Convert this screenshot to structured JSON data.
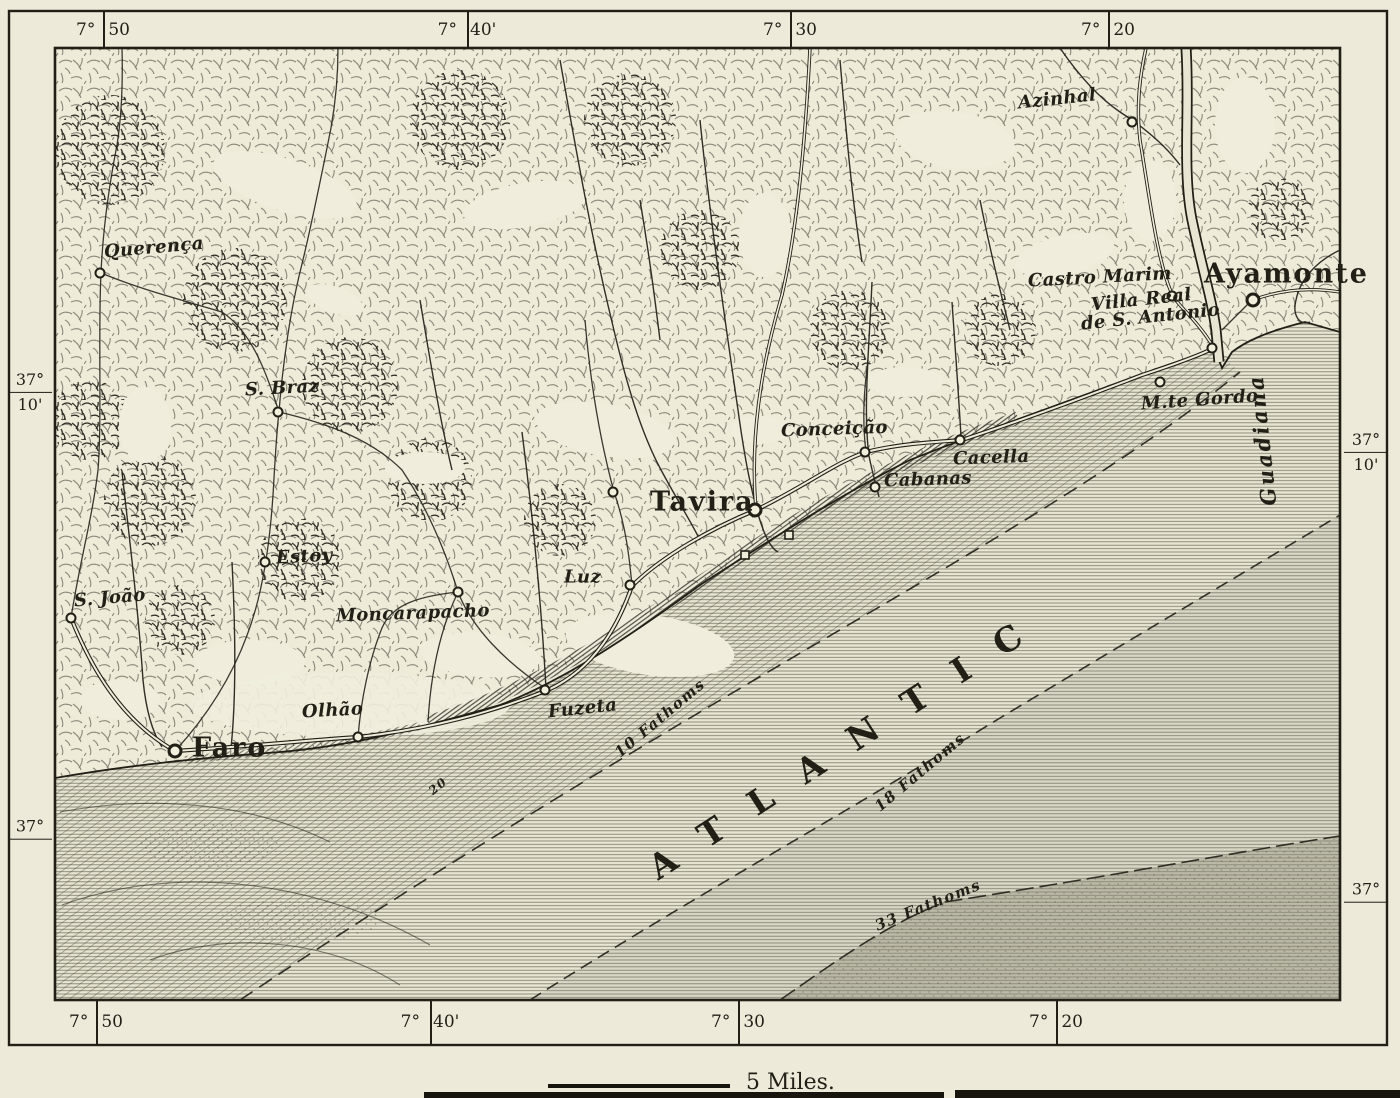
{
  "map": {
    "colors": {
      "paper": "#edead9",
      "ink": "#211f16",
      "sea": "#e8e5d2",
      "sea_deep": "#8b8a7a"
    },
    "scale": {
      "label": "5 Miles."
    },
    "graticule": {
      "top": [
        {
          "deg": "7°",
          "min": "50",
          "x": 103
        },
        {
          "deg": "7°",
          "min": "40'",
          "x": 467
        },
        {
          "deg": "7°",
          "min": "30",
          "x": 790
        },
        {
          "deg": "7°",
          "min": "20",
          "x": 1108
        }
      ],
      "bottom": [
        {
          "deg": "7°",
          "min": "50",
          "x": 96
        },
        {
          "deg": "7°",
          "min": "40'",
          "x": 430
        },
        {
          "deg": "7°",
          "min": "30",
          "x": 738
        },
        {
          "deg": "7°",
          "min": "20",
          "x": 1056
        }
      ],
      "left": [
        {
          "deg": "37°",
          "min": "10'",
          "y": 392
        },
        {
          "deg": "37°",
          "min": "",
          "y": 830
        }
      ],
      "right": [
        {
          "deg": "37°",
          "min": "10'",
          "y": 452
        },
        {
          "deg": "37°",
          "min": "",
          "y": 893
        }
      ]
    },
    "places": [
      {
        "id": "querenca",
        "label": "Querença",
        "x": 104,
        "y": 252,
        "rot": -5,
        "cx": 100,
        "cy": 273,
        "class": "village"
      },
      {
        "id": "azinhal",
        "label": "Azinhal",
        "x": 1018,
        "y": 103,
        "rot": -6,
        "cx": 1132,
        "cy": 122,
        "class": "village"
      },
      {
        "id": "castro-marim",
        "label": "Castro Marim",
        "x": 1028,
        "y": 281,
        "rot": -3,
        "cx": 1172,
        "cy": 296,
        "class": "village"
      },
      {
        "id": "ayamonte",
        "label": "Ayamonte",
        "x": 1204,
        "y": 274,
        "cx": 1253,
        "cy": 300,
        "class": "city"
      },
      {
        "id": "villa-real",
        "label": "Villa Real",
        "label2": "de S. Antonio",
        "x": 1092,
        "y": 314,
        "rot": -6,
        "cx": 1212,
        "cy": 348,
        "class": "village"
      },
      {
        "id": "monte-gordo",
        "label": "M.te Gordo",
        "x": 1141,
        "y": 404,
        "rot": -4,
        "cx": 1160,
        "cy": 382,
        "class": "village"
      },
      {
        "id": "conceicao",
        "label": "Conceição",
        "x": 781,
        "y": 431,
        "rot": -2,
        "cx": 865,
        "cy": 452,
        "class": "village"
      },
      {
        "id": "cacella",
        "label": "Cacella",
        "x": 953,
        "y": 459,
        "rot": -2,
        "cx": 960,
        "cy": 440,
        "class": "village"
      },
      {
        "id": "cabanas",
        "label": "Cabanas",
        "x": 884,
        "y": 481,
        "rot": -2,
        "cx": 875,
        "cy": 487,
        "class": "village"
      },
      {
        "id": "tavira",
        "label": "Tavira",
        "x": 650,
        "y": 502,
        "cx": 755,
        "cy": 510,
        "class": "city"
      },
      {
        "id": "tavira-west",
        "label": "",
        "cx": 613,
        "cy": 492
      },
      {
        "id": "luz",
        "label": "Luz",
        "x": 564,
        "y": 577,
        "cx": 630,
        "cy": 585,
        "class": "village"
      },
      {
        "id": "s-braz",
        "label": "S. Braz",
        "x": 245,
        "y": 390,
        "rot": -3,
        "cx": 278,
        "cy": 412,
        "class": "village"
      },
      {
        "id": "estoy",
        "label": "Estoy",
        "x": 276,
        "y": 558,
        "rot": -3,
        "cx": 265,
        "cy": 562,
        "class": "village"
      },
      {
        "id": "moncarapacho",
        "label": "Moncarapacho",
        "x": 336,
        "y": 616,
        "rot": -2,
        "cx": 458,
        "cy": 592,
        "class": "village"
      },
      {
        "id": "s-joao",
        "label": "S. João",
        "x": 74,
        "y": 601,
        "rot": -5,
        "cx": 71,
        "cy": 618,
        "class": "village"
      },
      {
        "id": "olhao",
        "label": "Olhão",
        "x": 302,
        "y": 712,
        "rot": -3,
        "cx": 358,
        "cy": 737,
        "class": "village"
      },
      {
        "id": "faro",
        "label": "Faro",
        "x": 192,
        "y": 748,
        "cx": 175,
        "cy": 751,
        "class": "city"
      },
      {
        "id": "fuzeta",
        "label": "Fuzeta",
        "x": 548,
        "y": 712,
        "rot": -6,
        "cx": 545,
        "cy": 690,
        "class": "village"
      }
    ],
    "sea_labels": [
      {
        "id": "atlantic",
        "text": "ATLANTIC",
        "x": 850,
        "y": 743,
        "rot": -33,
        "class": "ocean"
      },
      {
        "id": "fathoms-10",
        "text": "10 Fathoms",
        "x": 660,
        "y": 718,
        "rot": -40,
        "class": "fathom"
      },
      {
        "id": "fathoms-18",
        "text": "18 Fathoms",
        "x": 920,
        "y": 772,
        "rot": -40,
        "class": "fathom"
      },
      {
        "id": "fathoms-33",
        "text": "33 Fathoms",
        "x": 928,
        "y": 905,
        "rot": -22,
        "class": "fathom"
      },
      {
        "id": "depth-20",
        "text": "20",
        "x": 438,
        "y": 786,
        "rot": -40,
        "class": "fathom small"
      },
      {
        "id": "guadiana",
        "text": "Guadiana",
        "x": 1262,
        "y": 440,
        "rot": -96,
        "class": "river"
      }
    ]
  }
}
